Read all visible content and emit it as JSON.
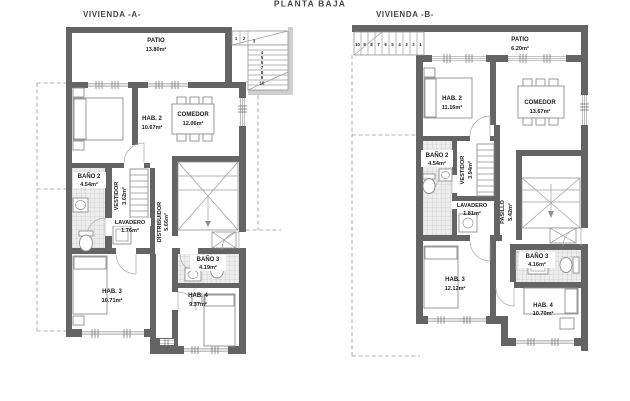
{
  "page": {
    "title": "PLANTA BAJA",
    "background_color": "#ffffff"
  },
  "colors": {
    "wall": "#646464",
    "light_wall": "#cfcfcf",
    "tile_line": "#c2c2c2",
    "furniture_line": "#8f8f8f",
    "text": "#1c1c1c"
  },
  "plans": [
    {
      "title": "VIVIENDA -A-",
      "rooms": [
        {
          "name": "PATIO",
          "area": "13.80m²"
        },
        {
          "name": "HAB. 2",
          "area": "10.67m²"
        },
        {
          "name": "COMEDOR",
          "area": "12.06m²"
        },
        {
          "name": "BAÑO 2",
          "area": "4.54m²"
        },
        {
          "name": "VESTIDOR",
          "area": "3.62m²"
        },
        {
          "name": "LAVADERO",
          "area": "1.76m²"
        },
        {
          "name": "DISTRIBUIDOR",
          "area": "5.66m²"
        },
        {
          "name": "BAÑO 3",
          "area": "4.19m²"
        },
        {
          "name": "HAB. 3",
          "area": "10.71m²"
        },
        {
          "name": "HAB. 4",
          "area": "9.37m²"
        }
      ],
      "stair_steps": [
        "1",
        "2",
        "3",
        "4",
        "5",
        "6",
        "7",
        "8",
        "9",
        "10"
      ]
    },
    {
      "title": "VIVIENDA -B-",
      "rooms": [
        {
          "name": "PATIO",
          "area": "6.20m²"
        },
        {
          "name": "HAB. 2",
          "area": "11.16m²"
        },
        {
          "name": "COMEDOR",
          "area": "13.67m²"
        },
        {
          "name": "BAÑO 2",
          "area": "4.54m²"
        },
        {
          "name": "VESTIDOR",
          "area": "3.94m²"
        },
        {
          "name": "LAVADERO",
          "area": "1.81m²"
        },
        {
          "name": "PASILLO",
          "area": "5.42m²"
        },
        {
          "name": "BAÑO 3",
          "area": "4.16m²"
        },
        {
          "name": "HAB. 3",
          "area": "12.12m²"
        },
        {
          "name": "HAB. 4",
          "area": "10.70m²"
        }
      ],
      "stair_steps": [
        "10",
        "9",
        "8",
        "7",
        "6",
        "5",
        "4",
        "3",
        "2",
        "1"
      ]
    }
  ]
}
